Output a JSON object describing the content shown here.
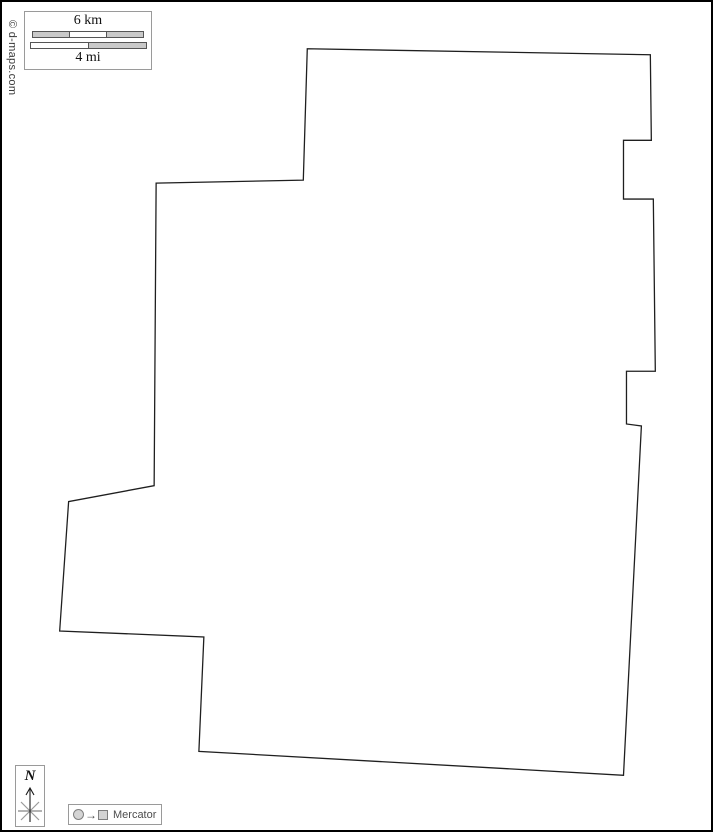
{
  "watermark": {
    "text": "© d-maps.com"
  },
  "scale_box": {
    "km_label": "6 km",
    "mi_label": "4 mi"
  },
  "compass": {
    "north_label": "N"
  },
  "projection_box": {
    "arrow_symbol": "→",
    "label": "Mercator"
  },
  "map": {
    "outline_points": "307,47 652,53 653,139 625,139 625,198 655,198 657,371 628,371 628,424 643,426 625,777 198,753 203,638 58,632 67,502 153,486 155,182 303,179",
    "outline_color": "#1f1f1f",
    "fill_color": "#ffffff"
  },
  "colors": {
    "frame": "#000000",
    "scale_bar_gray": "#c9c9c9",
    "box_border_gray": "#9a9a9a",
    "compass_gray": "#9a9a9a",
    "muted_text": "#4d4d4d"
  }
}
